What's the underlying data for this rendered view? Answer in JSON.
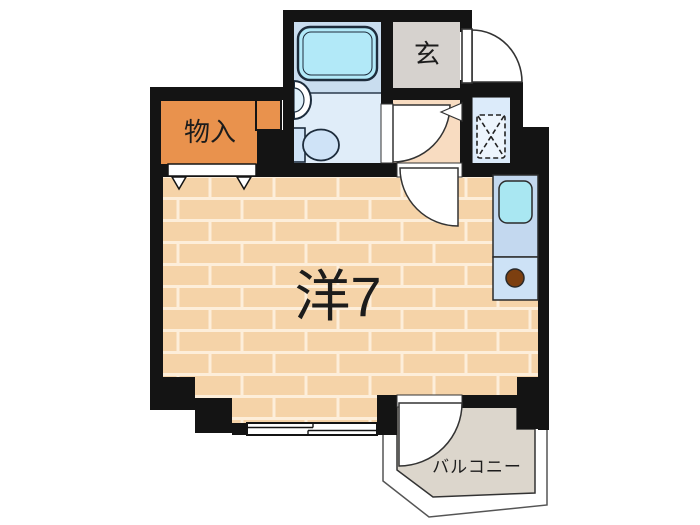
{
  "labels": {
    "western_room": "洋7",
    "storage": "物入",
    "entrance": "玄",
    "balcony": "バルコニー"
  },
  "colors": {
    "wall": "#141414",
    "floor": "#f5d3a8",
    "mortar": "#fdeeda",
    "hallway": "#f8dcc1",
    "storage": "#e9924d",
    "entrance_floor": "#d6d2ce",
    "bathroom_upper": "#c9ddef",
    "bathroom_lower": "#e0edf9",
    "bathtub": "#b2e9f8",
    "toilet": "#cfe3f7",
    "laundry_space": "#dcebfa",
    "laundry_box": "#edf5fd",
    "kitchen_upper": "#c3d8ef",
    "kitchen_lower": "#cde2f6",
    "kitchen_sink": "#a9e7f2",
    "burner": "#7c3f10",
    "balcony_floor": "#dcd6cc",
    "railing": "#ffffff"
  },
  "fixtures": {
    "bathtub": "bathtub",
    "washbasin": "washbasin",
    "toilet": "toilet",
    "laundry_space": "washing-machine-space",
    "kitchen_sink": "kitchen-sink",
    "burner": "stove-burner",
    "entrance_door": "entrance-door",
    "window": "sliding-window",
    "closet_doors": "closet-hanger-doors"
  }
}
